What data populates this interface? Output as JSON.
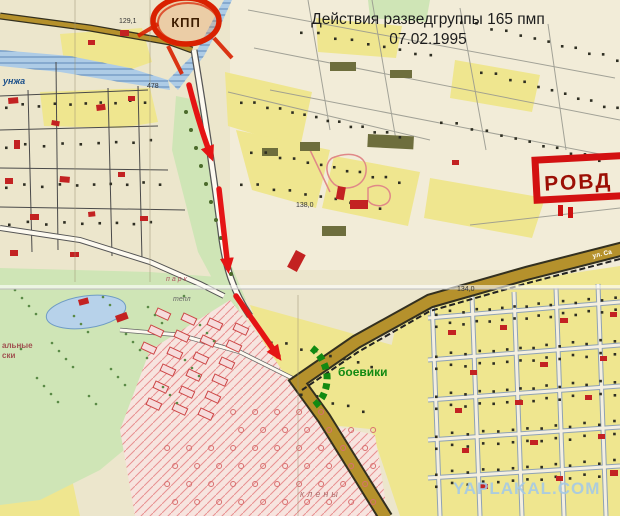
{
  "title": {
    "line1": "Действия разведгруппы 165 пмп",
    "line2": "07.02.1995"
  },
  "annotations": {
    "checkpoint": "КПП",
    "rovd": "РОВД",
    "militants": "боевики"
  },
  "watermark": "YAPLAKAL.COM",
  "map_labels": {
    "river_name": "унжа",
    "river_number": "478",
    "elevation_a": "129,1",
    "elevation_b": "138,0",
    "elevation_c": "134,0",
    "park": "парк",
    "greenhouse": "тепл",
    "maples": "клены",
    "fragment_a": "альные",
    "fragment_b": "ски",
    "street_main": "ул. Са"
  },
  "colors": {
    "arrow_red": "#e51414",
    "militant_green": "#128a12",
    "rovd_red": "#d31111",
    "rovd_text": "#9c0f05",
    "checkpoint_red": "#d92100",
    "watermark_blue": "#a3c9e8",
    "road_brown": "#b5912c",
    "block_yellow": "#efe68f",
    "park_green": "#cfe5b6",
    "river_blue": "#aecce6"
  }
}
